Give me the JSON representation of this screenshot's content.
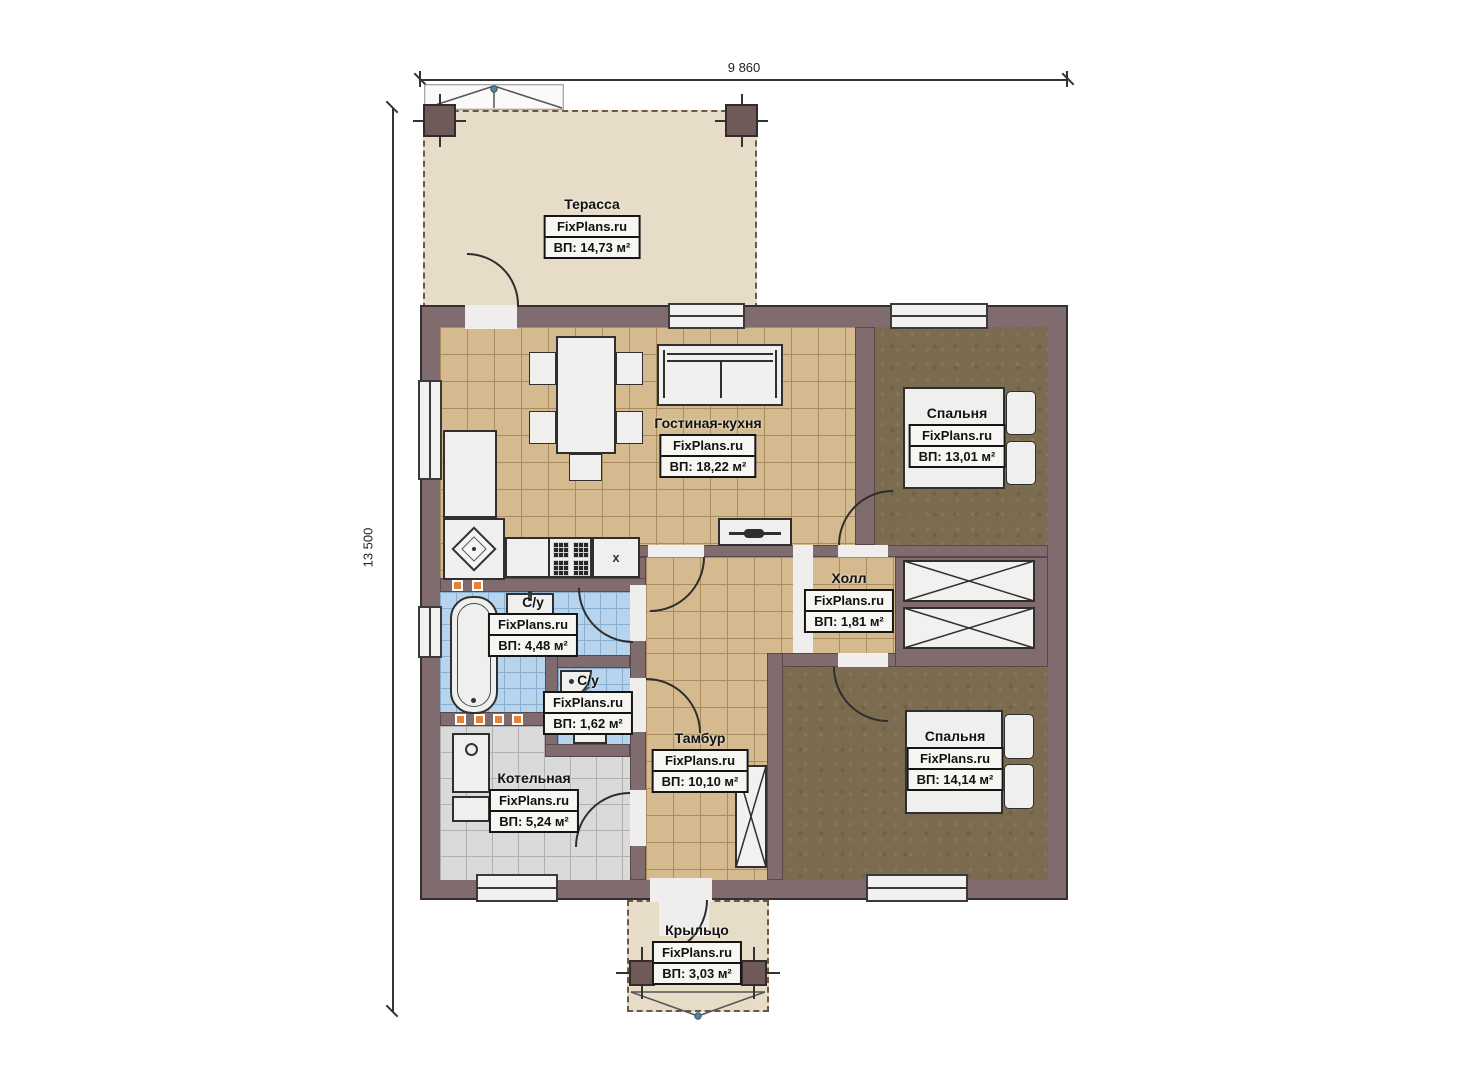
{
  "plan": {
    "brand": "FixPlans.ru",
    "dimensions": {
      "width": "9 860",
      "height": "13 500"
    },
    "kitchen_mark": "х",
    "rooms": [
      {
        "id": "terrace",
        "name": "Терасса",
        "brand": "FixPlans.ru",
        "area": "ВП: 14,73 м²"
      },
      {
        "id": "living-kitchen",
        "name": "Гостиная-кухня",
        "brand": "FixPlans.ru",
        "area": "ВП: 18,22 м²"
      },
      {
        "id": "bedroom-1",
        "name": "Спальня",
        "brand": "FixPlans.ru",
        "area": "ВП: 13,01 м²"
      },
      {
        "id": "hall",
        "name": "Холл",
        "brand": "FixPlans.ru",
        "area": "ВП: 1,81 м²"
      },
      {
        "id": "bathroom-1",
        "name": "С/у",
        "brand": "FixPlans.ru",
        "area": "ВП: 4,48 м²"
      },
      {
        "id": "bathroom-2",
        "name": "С/у",
        "brand": "FixPlans.ru",
        "area": "ВП: 1,62 м²"
      },
      {
        "id": "vestibule",
        "name": "Тамбур",
        "brand": "FixPlans.ru",
        "area": "ВП: 10,10 м²"
      },
      {
        "id": "boiler-room",
        "name": "Котельная",
        "brand": "FixPlans.ru",
        "area": "ВП: 5,24 м²"
      },
      {
        "id": "bedroom-2",
        "name": "Спальня",
        "brand": "FixPlans.ru",
        "area": "ВП: 14,14 м²"
      },
      {
        "id": "porch",
        "name": "Крыльцо",
        "brand": "FixPlans.ru",
        "area": "ВП: 3,03 м²"
      }
    ],
    "colors": {
      "wall": "#806c6f",
      "terrace_floor": "#e7dcc8",
      "living_floor": "#d4ba8e",
      "bedroom_floor": "#7b6c50",
      "bathroom_floor": "#b7d4ec",
      "boiler_floor": "#dadada",
      "accent_orange": "#e2823b"
    }
  }
}
